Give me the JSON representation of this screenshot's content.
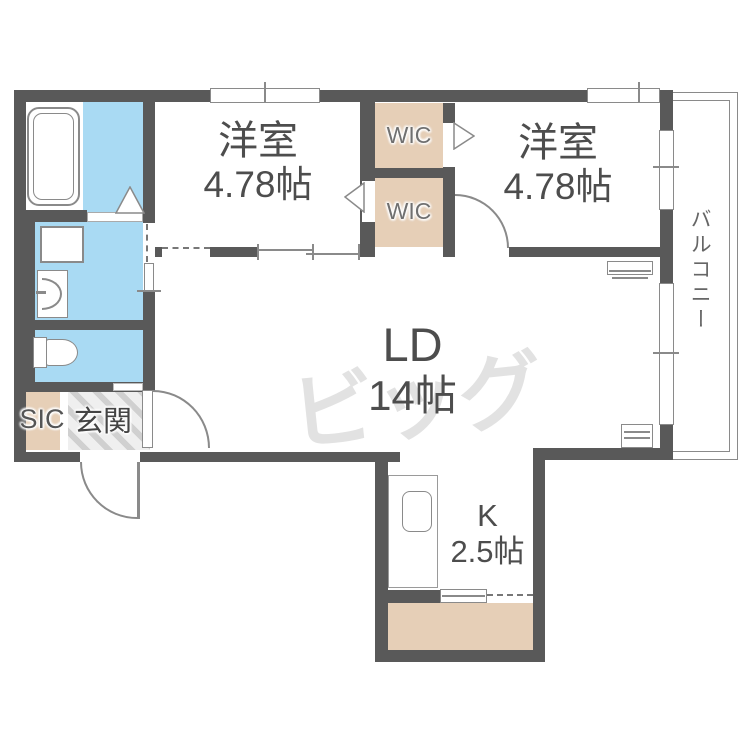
{
  "rooms": {
    "bedroom_left": {
      "name": "洋室",
      "size": "4.78帖"
    },
    "bedroom_right": {
      "name": "洋室",
      "size": "4.78帖"
    },
    "living_dining": {
      "name": "LD",
      "size": "14帖"
    },
    "kitchen": {
      "name": "K",
      "size": "2.5帖"
    },
    "wic_top": "WIC",
    "wic_bottom": "WIC",
    "sic": "SIC",
    "entrance": "玄関",
    "balcony": "バルコニー"
  },
  "watermark": "ビッグ",
  "colors": {
    "wall": "#595959",
    "water": "#a9daf3",
    "closet": "#e6cfb7",
    "line": "#8a8a8a",
    "text": "#4d4d4d"
  }
}
